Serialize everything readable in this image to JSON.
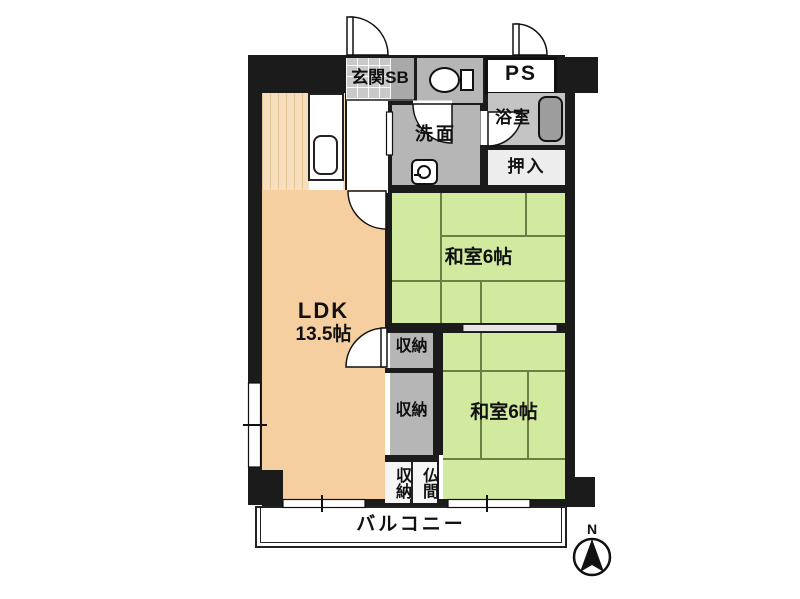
{
  "page_title": "間取り図",
  "colors": {
    "wall": "#1b1b1b",
    "tatami": "#d2ea9f",
    "tatami-line": "#6b7f44",
    "ldk-floor": "#f5cfa0",
    "kitchen-floor": "#f7dfbd",
    "gray-room": "#b6b6b6",
    "bath-floor": "#c4c4c4",
    "tub": "#9d9d9d",
    "tile": "#c9c9c9",
    "sb": "#a9a9a9",
    "closet-light": "#f6f6f6",
    "oshiire": "#ededed",
    "paper": "#ffffff",
    "ink": "#111111"
  },
  "rooms": {
    "entrance": "玄関SB",
    "pipe_space": "PS",
    "bathroom": "浴室",
    "washroom": "洗面",
    "oshiire": "押入",
    "tatami_upper": "和室6帖",
    "tatami_lower": "和室6帖",
    "ldk_name": "LDK",
    "ldk_size": "13.5帖",
    "storage_upper": "収納",
    "storage_mid": "収納",
    "storage_bottom": "収納",
    "butsuma": "仏間",
    "balcony": "バルコニー"
  },
  "compass": {
    "north": "N"
  }
}
